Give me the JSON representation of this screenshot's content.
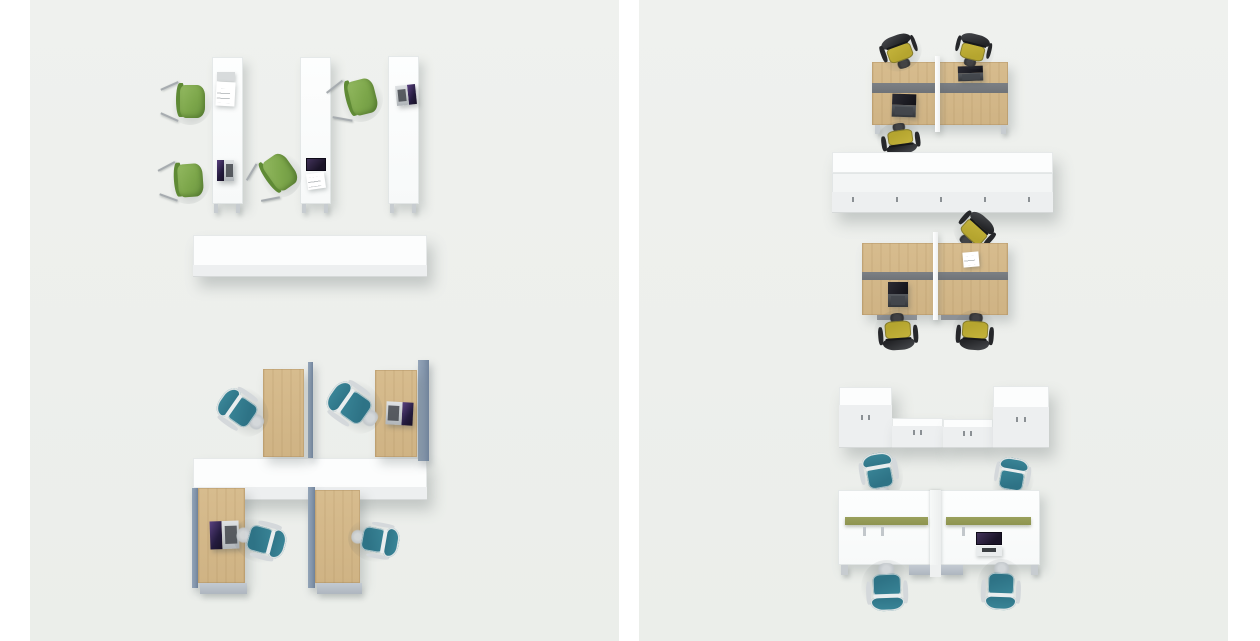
{
  "palette": {
    "panel_bg": "#eff1ee",
    "white_furniture": "#fbfcfc",
    "wood": "#d7bc8e",
    "partition_blue": "#8496ac",
    "divider_gray": "#6f7378",
    "divider_olive": "#8e944f",
    "chair_green": "#7ca64a",
    "chair_teal": "#2e7386",
    "chair_yellow": "#b5a52f",
    "laptop_screen_glow": "#5a4180",
    "shadow": "rgba(100,110,110,0.3)"
  },
  "panels": {
    "left": {
      "scene_top": {
        "label": "three-white-single-desks-with-green-guest-chairs",
        "white_desks": 3,
        "green_guest_chairs": 4,
        "laptops": 2,
        "monitors": 1,
        "paper_documents": 1,
        "storage_row_units": 4
      },
      "scene_bottom": {
        "label": "four-oak-desks-with-blue-side-screens-and-teal-task-chairs",
        "oak_desks": 4,
        "blue_side_screens": 4,
        "teal_task_chairs": 4,
        "laptops": 2,
        "central_storage_row_units": 4
      }
    },
    "right": {
      "scene_top_cluster": {
        "label": "four-seat-oak-bench-cluster-with-yellow-chairs",
        "oak_desks": 4,
        "yellow_task_chairs": 3,
        "laptops": 2
      },
      "storage_row_middle": {
        "label": "double-sided-white-cabinet-row-with-drawer-fronts",
        "units": 5
      },
      "scene_middle_cluster": {
        "label": "four-seat-oak-bench-cluster-with-yellow-chairs",
        "oak_desks": 4,
        "yellow_task_chairs": 3,
        "laptops": 1,
        "paper_documents": 1
      },
      "storage_group_lower": {
        "label": "white-wardrobes-and-low-cabinets",
        "tall_wardrobes": 2,
        "low_cabinets": 2
      },
      "scene_bottom_cluster": {
        "label": "four-seat-white-bench-with-olive-rails-and-teal-chairs",
        "white_desks": 4,
        "teal_task_chairs": 4,
        "monitors": 1,
        "olive_rails": 2
      }
    }
  }
}
